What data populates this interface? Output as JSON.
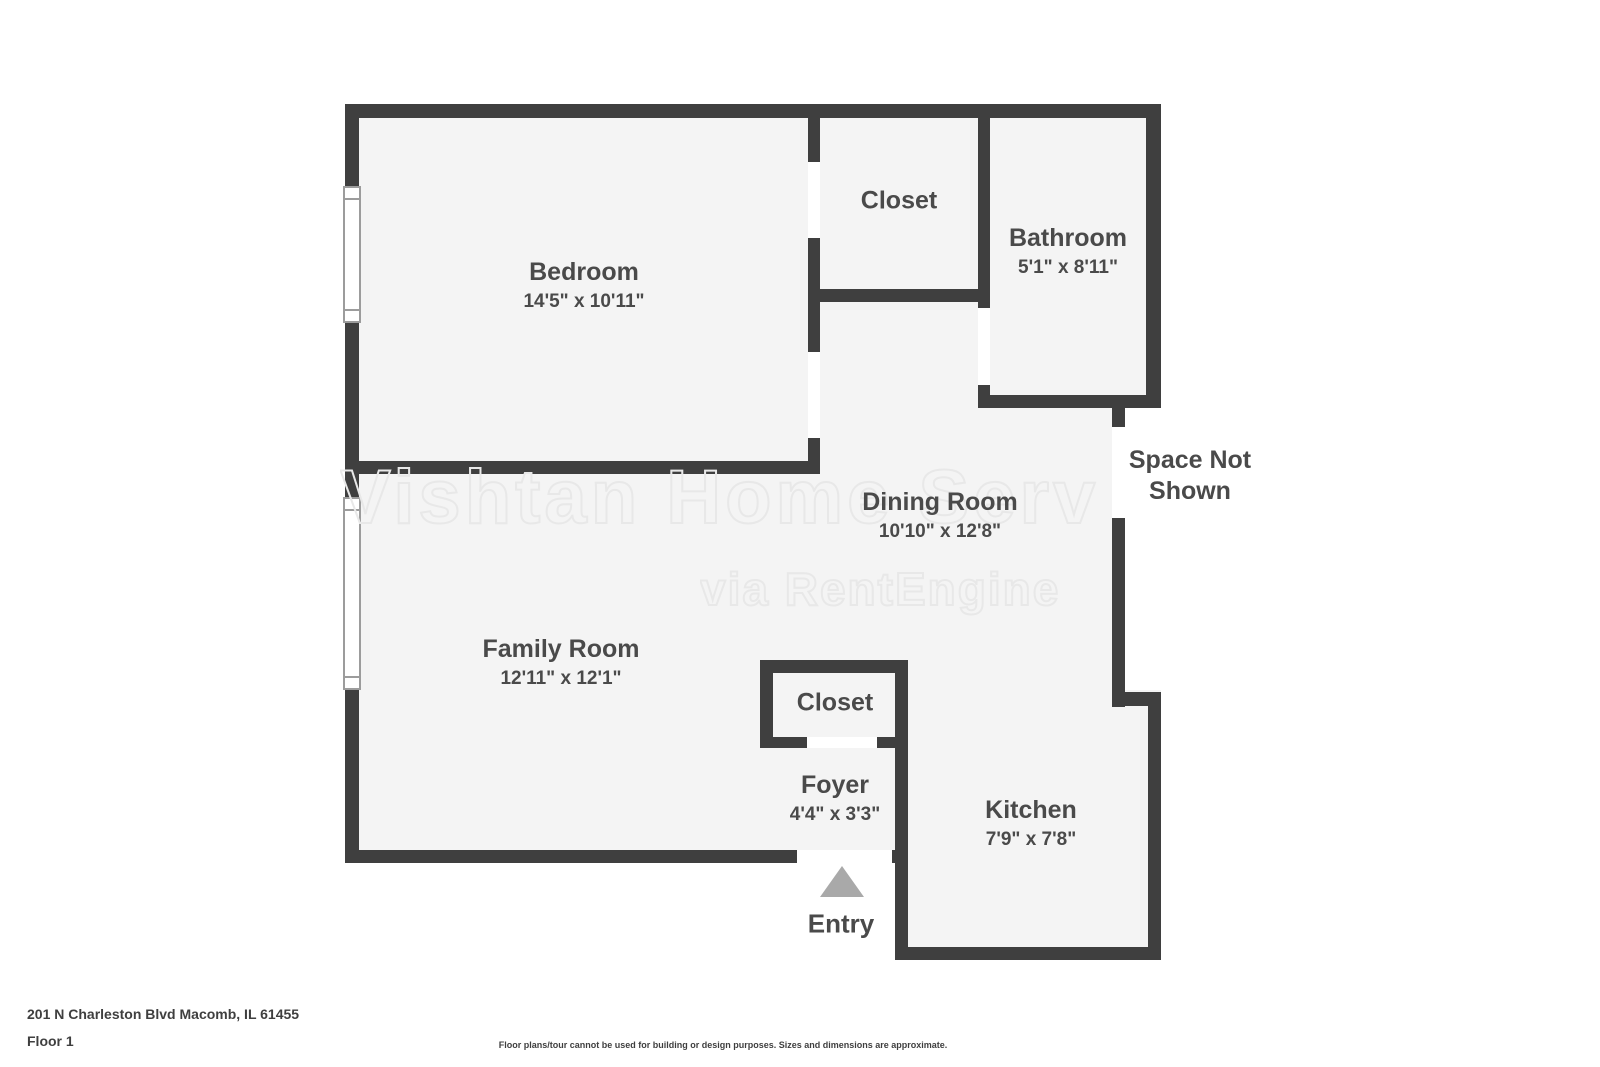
{
  "watermark": {
    "line1": "Vishtan Home Serv",
    "line2": "via RentEngine"
  },
  "rooms": {
    "bedroom": {
      "name": "Bedroom",
      "dims": "14'5\" x 10'11\""
    },
    "closet_upper": {
      "name": "Closet"
    },
    "bathroom": {
      "name": "Bathroom",
      "dims": "5'1\" x 8'11\""
    },
    "dining_room": {
      "name": "Dining Room",
      "dims": "10'10\" x 12'8\""
    },
    "family_room": {
      "name": "Family Room",
      "dims": "12'11\" x 12'1\""
    },
    "closet_lower": {
      "name": "Closet"
    },
    "foyer": {
      "name": "Foyer",
      "dims": "4'4\" x 3'3\""
    },
    "kitchen": {
      "name": "Kitchen",
      "dims": "7'9\" x 7'8\""
    }
  },
  "annotations": {
    "space_not_shown_line1": "Space Not",
    "space_not_shown_line2": "Shown",
    "entry": "Entry"
  },
  "footer": {
    "address": "201 N Charleston Blvd Macomb, IL 61455",
    "floor_label": "Floor 1",
    "disclaimer": "Floor plans/tour cannot be used for building or design purposes. Sizes and dimensions are approximate."
  },
  "colors": {
    "wall": "#3f3f3f",
    "room_fill": "#f4f4f4",
    "label_text": "#4a4a4a",
    "entry_arrow": "#a9a9a9",
    "watermark_outline": "#e8e8e8"
  }
}
